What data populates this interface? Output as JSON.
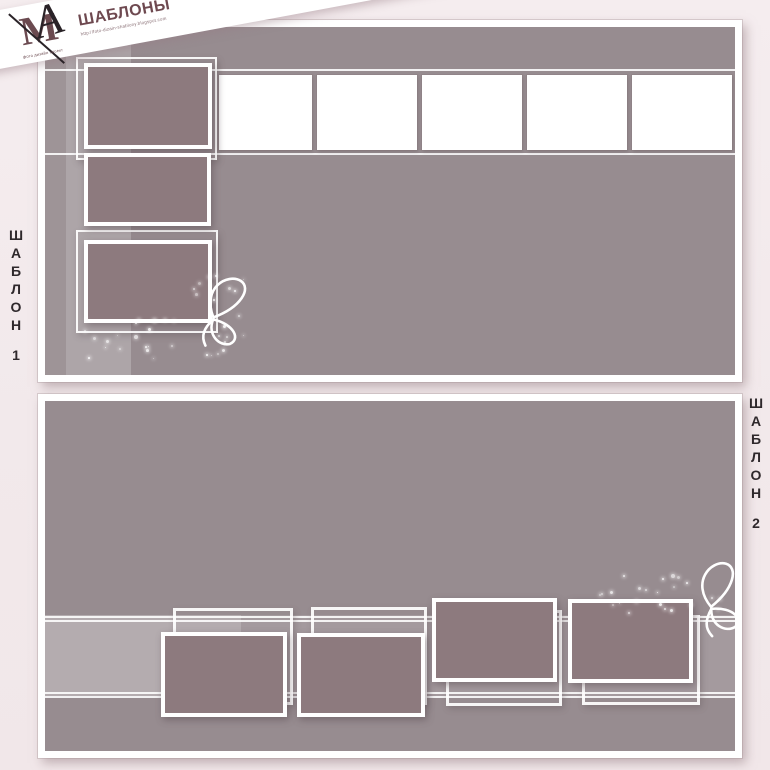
{
  "brand": {
    "monogram_m": "М",
    "monogram_a": "А",
    "title": "ШАБЛОНЫ",
    "monogram_caption": "фото дизайн проект",
    "url": "http://foto-dizain-shablony.blogspot.com"
  },
  "labels": {
    "template1": "ШАБЛОН 1",
    "template2": "ШАБЛОН 2"
  },
  "panels": {
    "panel1": {
      "name": "ШАБЛОН 1",
      "empty_photo_slots": 5,
      "filled_photo_slots": 3,
      "decorations": [
        "butterfly-flourish",
        "sparkles"
      ]
    },
    "panel2": {
      "name": "ШАБЛОН 2",
      "empty_photo_slots": 4,
      "filled_photo_slots": 4,
      "decorations": [
        "butterfly-flourish",
        "sparkles"
      ]
    }
  },
  "colors": {
    "page_background": "#f2e9eb",
    "panel_background": "#978c90",
    "photo_fill": "#8d7a7e",
    "slot_white": "#ffffff",
    "brand_maroon": "#6e4950",
    "label_text": "#2e282b"
  }
}
